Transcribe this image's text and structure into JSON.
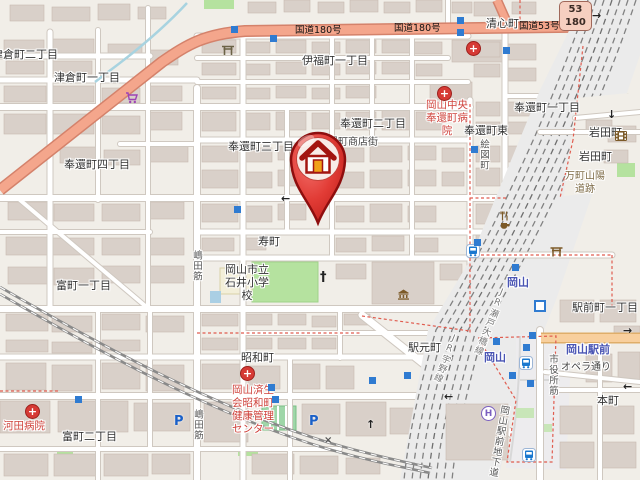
{
  "map": {
    "region": "Okayama Station area (Kita-ku, Okayama, Japan)",
    "route_shield": {
      "top": "53",
      "bottom": "180"
    },
    "marker": {
      "type": "home-pin",
      "description": "red map pin with house icon"
    },
    "colors": {
      "land": "#f1eee8",
      "building": "#d9d0c9",
      "building_stroke": "#c6bab0",
      "road_trunk": "#f4a68c",
      "road_trunk_casing": "#d4826b",
      "road_primary": "#f8cf9d",
      "road_primary_casing": "#dfae6a",
      "road_minor": "#ffffff",
      "road_minor_casing": "#cfc8c0",
      "rail_bed": "#ebebeb",
      "rail_track": "#6e6e6e",
      "water": "#a8d3e0",
      "boundary": "#e05c4f",
      "green": "#b5e29f",
      "plaza": "#edecee",
      "label": "#333333",
      "hospital_label": "#cf423b",
      "station_label": "#4a55b4",
      "historic_label": "#7d6a45",
      "marker_red": "#e23c36",
      "marker_door": "#f0a019"
    },
    "labels": [
      {
        "id": "label-tsukuracho-2",
        "t": "津倉町二丁目",
        "x": -8,
        "y": 48,
        "c": "place"
      },
      {
        "id": "label-tsukuracho-1",
        "t": "津倉町一丁目",
        "x": 54,
        "y": 71,
        "c": "place"
      },
      {
        "id": "label-ifukucho-1",
        "t": "伊福町一丁目",
        "x": 302,
        "y": 54,
        "c": "place"
      },
      {
        "id": "label-seishincho",
        "t": "清心町",
        "x": 486,
        "y": 17,
        "c": "place"
      },
      {
        "id": "label-hokancho-1",
        "t": "奉還町一丁目",
        "x": 514,
        "y": 101,
        "c": "place"
      },
      {
        "id": "label-hokancho-2",
        "t": "奉還町二丁目",
        "x": 340,
        "y": 117,
        "c": "place"
      },
      {
        "id": "label-hokancho-3",
        "t": "奉還町三丁目",
        "x": 228,
        "y": 140,
        "c": "place"
      },
      {
        "id": "label-hokancho-shotengai",
        "t": "奉還町商店街",
        "x": 318,
        "y": 136,
        "c": "place-sm"
      },
      {
        "id": "label-hokancho-4",
        "t": "奉還町四丁目",
        "x": 64,
        "y": 158,
        "c": "place"
      },
      {
        "id": "label-hokancho-higashi",
        "t": "奉還町東",
        "x": 464,
        "y": 124,
        "c": "place"
      },
      {
        "id": "label-iwatacho-1",
        "t": "岩田町",
        "x": 589,
        "y": 126,
        "c": "place"
      },
      {
        "id": "label-iwatacho-2",
        "t": "岩田町",
        "x": 579,
        "y": 150,
        "c": "place"
      },
      {
        "id": "label-kotobukicho",
        "t": "寿町",
        "x": 258,
        "y": 235,
        "c": "place"
      },
      {
        "id": "label-ishii-elementary-school",
        "t": "岡山市立\n石井小学\n校",
        "x": 247,
        "y": 263,
        "c": "place",
        "ctr": 1
      },
      {
        "id": "label-tomimachi-1",
        "t": "富町一丁目",
        "x": 56,
        "y": 279,
        "c": "place"
      },
      {
        "id": "label-ekimotocho",
        "t": "駅元町",
        "x": 408,
        "y": 341,
        "c": "place"
      },
      {
        "id": "label-showacho",
        "t": "昭和町",
        "x": 241,
        "y": 351,
        "c": "place"
      },
      {
        "id": "label-tomimachi-2",
        "t": "富町二丁目",
        "x": 62,
        "y": 430,
        "c": "place"
      },
      {
        "id": "label-ekimaecho-1",
        "t": "駅前町一丁目",
        "x": 572,
        "y": 301,
        "c": "place"
      },
      {
        "id": "label-honmachi",
        "t": "本町",
        "x": 597,
        "y": 394,
        "c": "place"
      },
      {
        "id": "label-kawada-hospital",
        "t": "河田病院",
        "x": 3,
        "y": 420,
        "c": "hosp"
      },
      {
        "id": "label-okayama-chuo-hokancho-hospital",
        "t": "岡山中央\n奉還町病\n院",
        "x": 447,
        "y": 99,
        "c": "hosp",
        "ctr": 1
      },
      {
        "id": "label-saiseikai-showacho-health-center",
        "t": "岡山済生\n会昭和町\n健康管理\nセンター",
        "x": 253,
        "y": 384,
        "c": "hosp",
        "ctr": 1
      },
      {
        "id": "label-okayama-station-n",
        "t": "岡山",
        "x": 507,
        "y": 276,
        "c": "sta"
      },
      {
        "id": "label-okayama-station-s",
        "t": "岡山",
        "x": 484,
        "y": 351,
        "c": "sta"
      },
      {
        "id": "label-okayama-ekimae-stop",
        "t": "岡山駅前",
        "x": 566,
        "y": 343,
        "c": "sta"
      },
      {
        "id": "label-opera-dori",
        "t": "オペラ通り",
        "x": 561,
        "y": 361,
        "c": "place-sm"
      },
      {
        "id": "label-mancho-sanyodo-ruins",
        "t": "万町山陽\n道跡",
        "x": 585,
        "y": 170,
        "c": "hist",
        "ctr": 1
      },
      {
        "id": "label-route180-a",
        "t": "国道180号",
        "x": 295,
        "y": 24,
        "c": "road"
      },
      {
        "id": "label-route180-b",
        "t": "国道180号",
        "x": 394,
        "y": 22,
        "c": "road"
      },
      {
        "id": "label-route53",
        "t": "国道53号",
        "x": 519,
        "y": 20,
        "c": "road"
      },
      {
        "id": "label-ezucho",
        "t": "絵図町",
        "x": 477,
        "y": 139,
        "c": "vstreet",
        "v": 1
      },
      {
        "id": "label-shimada-suji-n",
        "t": "嶋田筋",
        "x": 190,
        "y": 250,
        "c": "vstreet",
        "v": 1
      },
      {
        "id": "label-shimada-suji-s",
        "t": "嶋田筋",
        "x": 191,
        "y": 409,
        "c": "vstreet",
        "v": 1
      },
      {
        "id": "label-shiyakusho-suji",
        "t": "市役所筋",
        "x": 546,
        "y": 354,
        "c": "vstreet",
        "v": 1
      },
      {
        "id": "label-jr-uno-line",
        "t": "JR宇野線",
        "x": 449,
        "y": 334,
        "c": "rail",
        "v": 1,
        "rot": 22
      },
      {
        "id": "label-jr-seto-ohashi-line",
        "t": "JR瀬戸大橋線",
        "x": 497,
        "y": 288,
        "c": "rail",
        "v": 1,
        "rot": 22
      },
      {
        "id": "label-okayama-ekimae-chikado",
        "t": "岡山駅前地下道",
        "x": 498,
        "y": 405,
        "c": "vstreet",
        "v": 1,
        "rot": 10
      }
    ],
    "icons": [
      {
        "n": "hospital-icon",
        "x": 466,
        "y": 41
      },
      {
        "n": "hospital-icon",
        "x": 437,
        "y": 86
      },
      {
        "n": "hospital-icon",
        "x": 240,
        "y": 366
      },
      {
        "n": "hospital-icon",
        "x": 25,
        "y": 404
      },
      {
        "n": "supermarket-icon",
        "x": 125,
        "y": 92
      },
      {
        "n": "shrine-icon",
        "x": 221,
        "y": 44
      },
      {
        "n": "torii-icon",
        "x": 550,
        "y": 246
      },
      {
        "n": "restaurant-icon",
        "x": 500,
        "y": 211
      },
      {
        "n": "cafe-icon",
        "x": 500,
        "y": 221
      },
      {
        "n": "museum-icon",
        "x": 397,
        "y": 289
      },
      {
        "n": "cinema-icon",
        "x": 615,
        "y": 131
      },
      {
        "n": "church-icon",
        "x": 320,
        "y": 270
      },
      {
        "n": "hotel-icon",
        "x": 481,
        "y": 406
      },
      {
        "n": "parking-icon",
        "x": 174,
        "y": 414
      },
      {
        "n": "parking-icon",
        "x": 309,
        "y": 414
      },
      {
        "n": "bus-station-icon",
        "x": 466,
        "y": 244
      },
      {
        "n": "bus-station-icon",
        "x": 519,
        "y": 356
      },
      {
        "n": "bus-station-icon",
        "x": 522,
        "y": 448
      },
      {
        "n": "tram-stop-icon",
        "x": 534,
        "y": 300
      },
      {
        "n": "poi-square-icon",
        "x": 231,
        "y": 26
      },
      {
        "n": "poi-square-icon",
        "x": 270,
        "y": 35
      },
      {
        "n": "poi-square-icon",
        "x": 457,
        "y": 17
      },
      {
        "n": "poi-square-icon",
        "x": 457,
        "y": 29
      },
      {
        "n": "poi-square-icon",
        "x": 503,
        "y": 47
      },
      {
        "n": "poi-square-icon",
        "x": 471,
        "y": 146
      },
      {
        "n": "poi-square-icon",
        "x": 234,
        "y": 206
      },
      {
        "n": "poi-square-icon",
        "x": 474,
        "y": 239
      },
      {
        "n": "poi-square-icon",
        "x": 512,
        "y": 264
      },
      {
        "n": "poi-square-icon",
        "x": 529,
        "y": 332
      },
      {
        "n": "poi-square-icon",
        "x": 523,
        "y": 344
      },
      {
        "n": "poi-square-icon",
        "x": 493,
        "y": 338
      },
      {
        "n": "poi-square-icon",
        "x": 509,
        "y": 372
      },
      {
        "n": "poi-square-icon",
        "x": 527,
        "y": 380
      },
      {
        "n": "poi-square-icon",
        "x": 75,
        "y": 396
      },
      {
        "n": "poi-square-icon",
        "x": 268,
        "y": 384
      },
      {
        "n": "poi-square-icon",
        "x": 272,
        "y": 396
      },
      {
        "n": "poi-square-icon",
        "x": 369,
        "y": 377
      },
      {
        "n": "poi-square-icon",
        "x": 404,
        "y": 372
      },
      {
        "n": "oneway-arrow-left-icon",
        "x": 281,
        "y": 192
      },
      {
        "n": "oneway-arrow-right-icon",
        "x": 592,
        "y": 9
      },
      {
        "n": "oneway-arrow-down-icon",
        "x": 607,
        "y": 108
      },
      {
        "n": "oneway-arrow-right-icon",
        "x": 623,
        "y": 324
      },
      {
        "n": "oneway-arrow-left-icon",
        "x": 623,
        "y": 380
      },
      {
        "n": "oneway-arrow-up-icon",
        "x": 366,
        "y": 418
      },
      {
        "n": "oneway-arrow-left-icon",
        "x": 444,
        "y": 390
      },
      {
        "n": "railway-crossing-icon",
        "x": 324,
        "y": 435
      }
    ]
  }
}
